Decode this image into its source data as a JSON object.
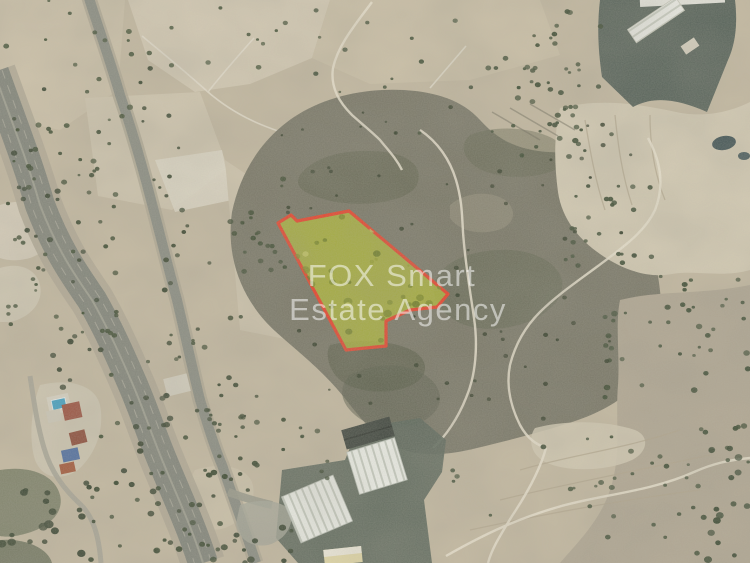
{
  "image": {
    "kind": "aerial-satellite-photo",
    "subject": "land plot highlighted for sale on satellite view"
  },
  "watermark": {
    "line1": "FOX Smart",
    "line2": "Estate Agency",
    "color": "#ffffff",
    "opacity": "0.52"
  },
  "plot": {
    "points": "278,223 291,215 297,221 349,211 448,294 437,307 410,310 386,321 386,346 346,350",
    "fill_color": "#b0b838",
    "fill_opacity": "0.82",
    "stroke_color": "#e8432c",
    "stroke_width": "3.2"
  }
}
